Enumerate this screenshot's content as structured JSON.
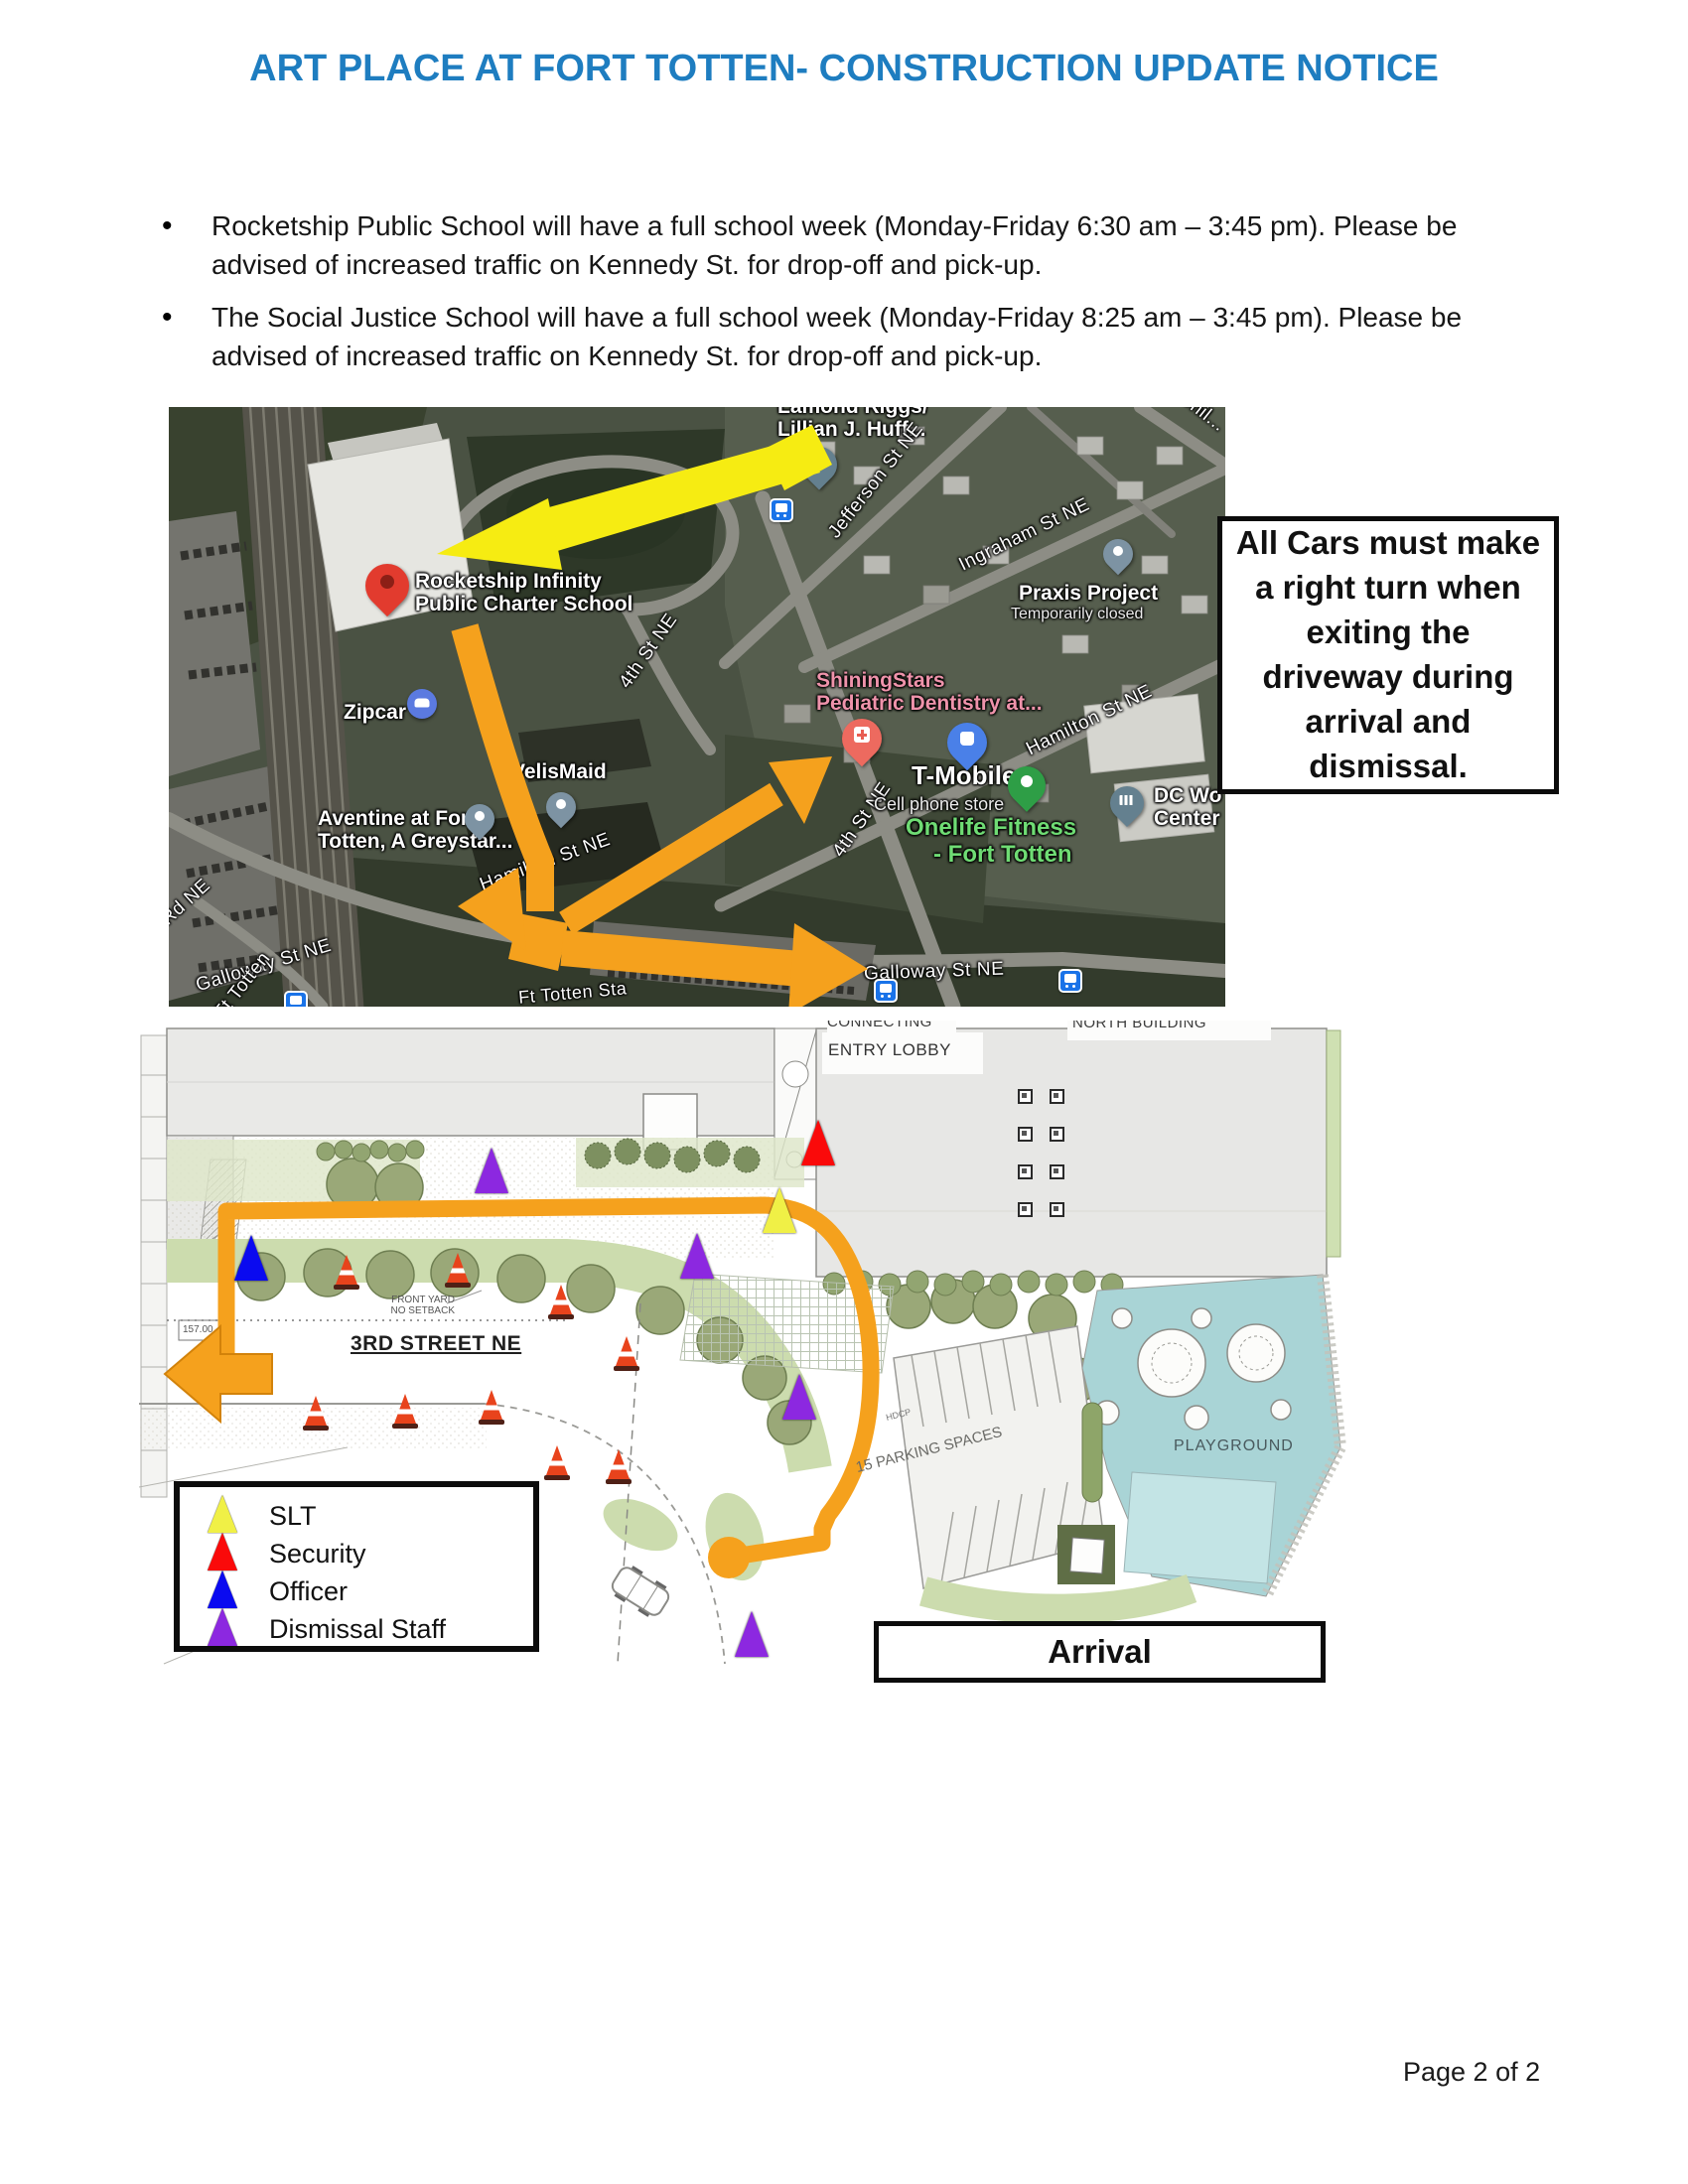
{
  "page": {
    "title": "ART PLACE AT FORT TOTTEN- CONSTRUCTION UPDATE NOTICE",
    "footer": "Page 2 of 2"
  },
  "bullets": [
    "Rocketship Public School will have a full school week (Monday-Friday 6:30 am – 3:45 pm). Please be advised of increased traffic on Kennedy St. for drop-off and pick-up.",
    "The Social Justice School will have a full school week (Monday-Friday 8:25 am – 3:45 pm). Please be advised of increased traffic on Kennedy St. for drop-off and pick-up."
  ],
  "callout": {
    "text": "All Cars must make a right turn when exiting the driveway during arrival and dismissal."
  },
  "map": {
    "places": {
      "lamond_line1": "Lamond Riggs/",
      "lamond_line2": "Lillian J. Huff...",
      "chillum": "Chil...",
      "praxis": "Praxis Project",
      "praxis_status": "Temporarily closed",
      "rocketship_line1": "Rocketship Infinity",
      "rocketship_line2": "Public Charter School",
      "zipcar": "Zipcar",
      "shiningstars_line1": "ShiningStars",
      "shiningstars_line2": "Pediatric Dentistry at...",
      "tmobile": "T-Mobile",
      "tmobile_sub": "Cell phone store",
      "onelife_line1": "Onelife Fitness",
      "onelife_line2": "- Fort Totten",
      "dc_line1": "DC Wo",
      "dc_line2": "Center",
      "velismaid": "VelisMaid",
      "aventine_line1": "Aventine at Fort",
      "aventine_line2": "Totten, A Greystar..."
    },
    "streets": {
      "jefferson": "Jefferson St NE",
      "ingraham": "Ingraham St NE",
      "hamilton": "Hamilton St NE",
      "hamilton_2": "Hamilton St NE",
      "fourth_1": "4th St NE",
      "fourth_2": "4th St NE",
      "galloway_1": "Galloway St NE",
      "galloway_2": "Galloway St NE",
      "ft_totten_sta": "Ft Totten Sta",
      "ft_totten_dr": "Ft Totten",
      "rd_ne": "Rd NE"
    }
  },
  "site_plan": {
    "labels": {
      "connecting": "CONNECTING",
      "entry_lobby": "ENTRY LOBBY",
      "north_building": "NORTH BUILDING",
      "front_yard": "FRONT YARD",
      "no_setback": "NO SETBACK",
      "third_street": "3RD STREET NE",
      "parking": "15 PARKING SPACES",
      "playground": "PLAYGROUND",
      "hdcp": "HDCP",
      "elevation": "157.00"
    },
    "legend": {
      "items": [
        {
          "label": "SLT",
          "color": "#f0f046"
        },
        {
          "label": "Security",
          "color": "#fa0a0a"
        },
        {
          "label": "Officer",
          "color": "#0a0af0"
        },
        {
          "label": "Dismissal Staff",
          "color": "#8c28e0"
        }
      ]
    },
    "arrival_label": "Arrival"
  },
  "colors": {
    "title_blue": "#1e7dc0",
    "route_orange": "#f5a11d",
    "route_yellow": "#f6ec12",
    "playground_teal": "#a9d4d6",
    "tree_olive": "#9aa878",
    "landscape_green": "#ccdcae"
  }
}
